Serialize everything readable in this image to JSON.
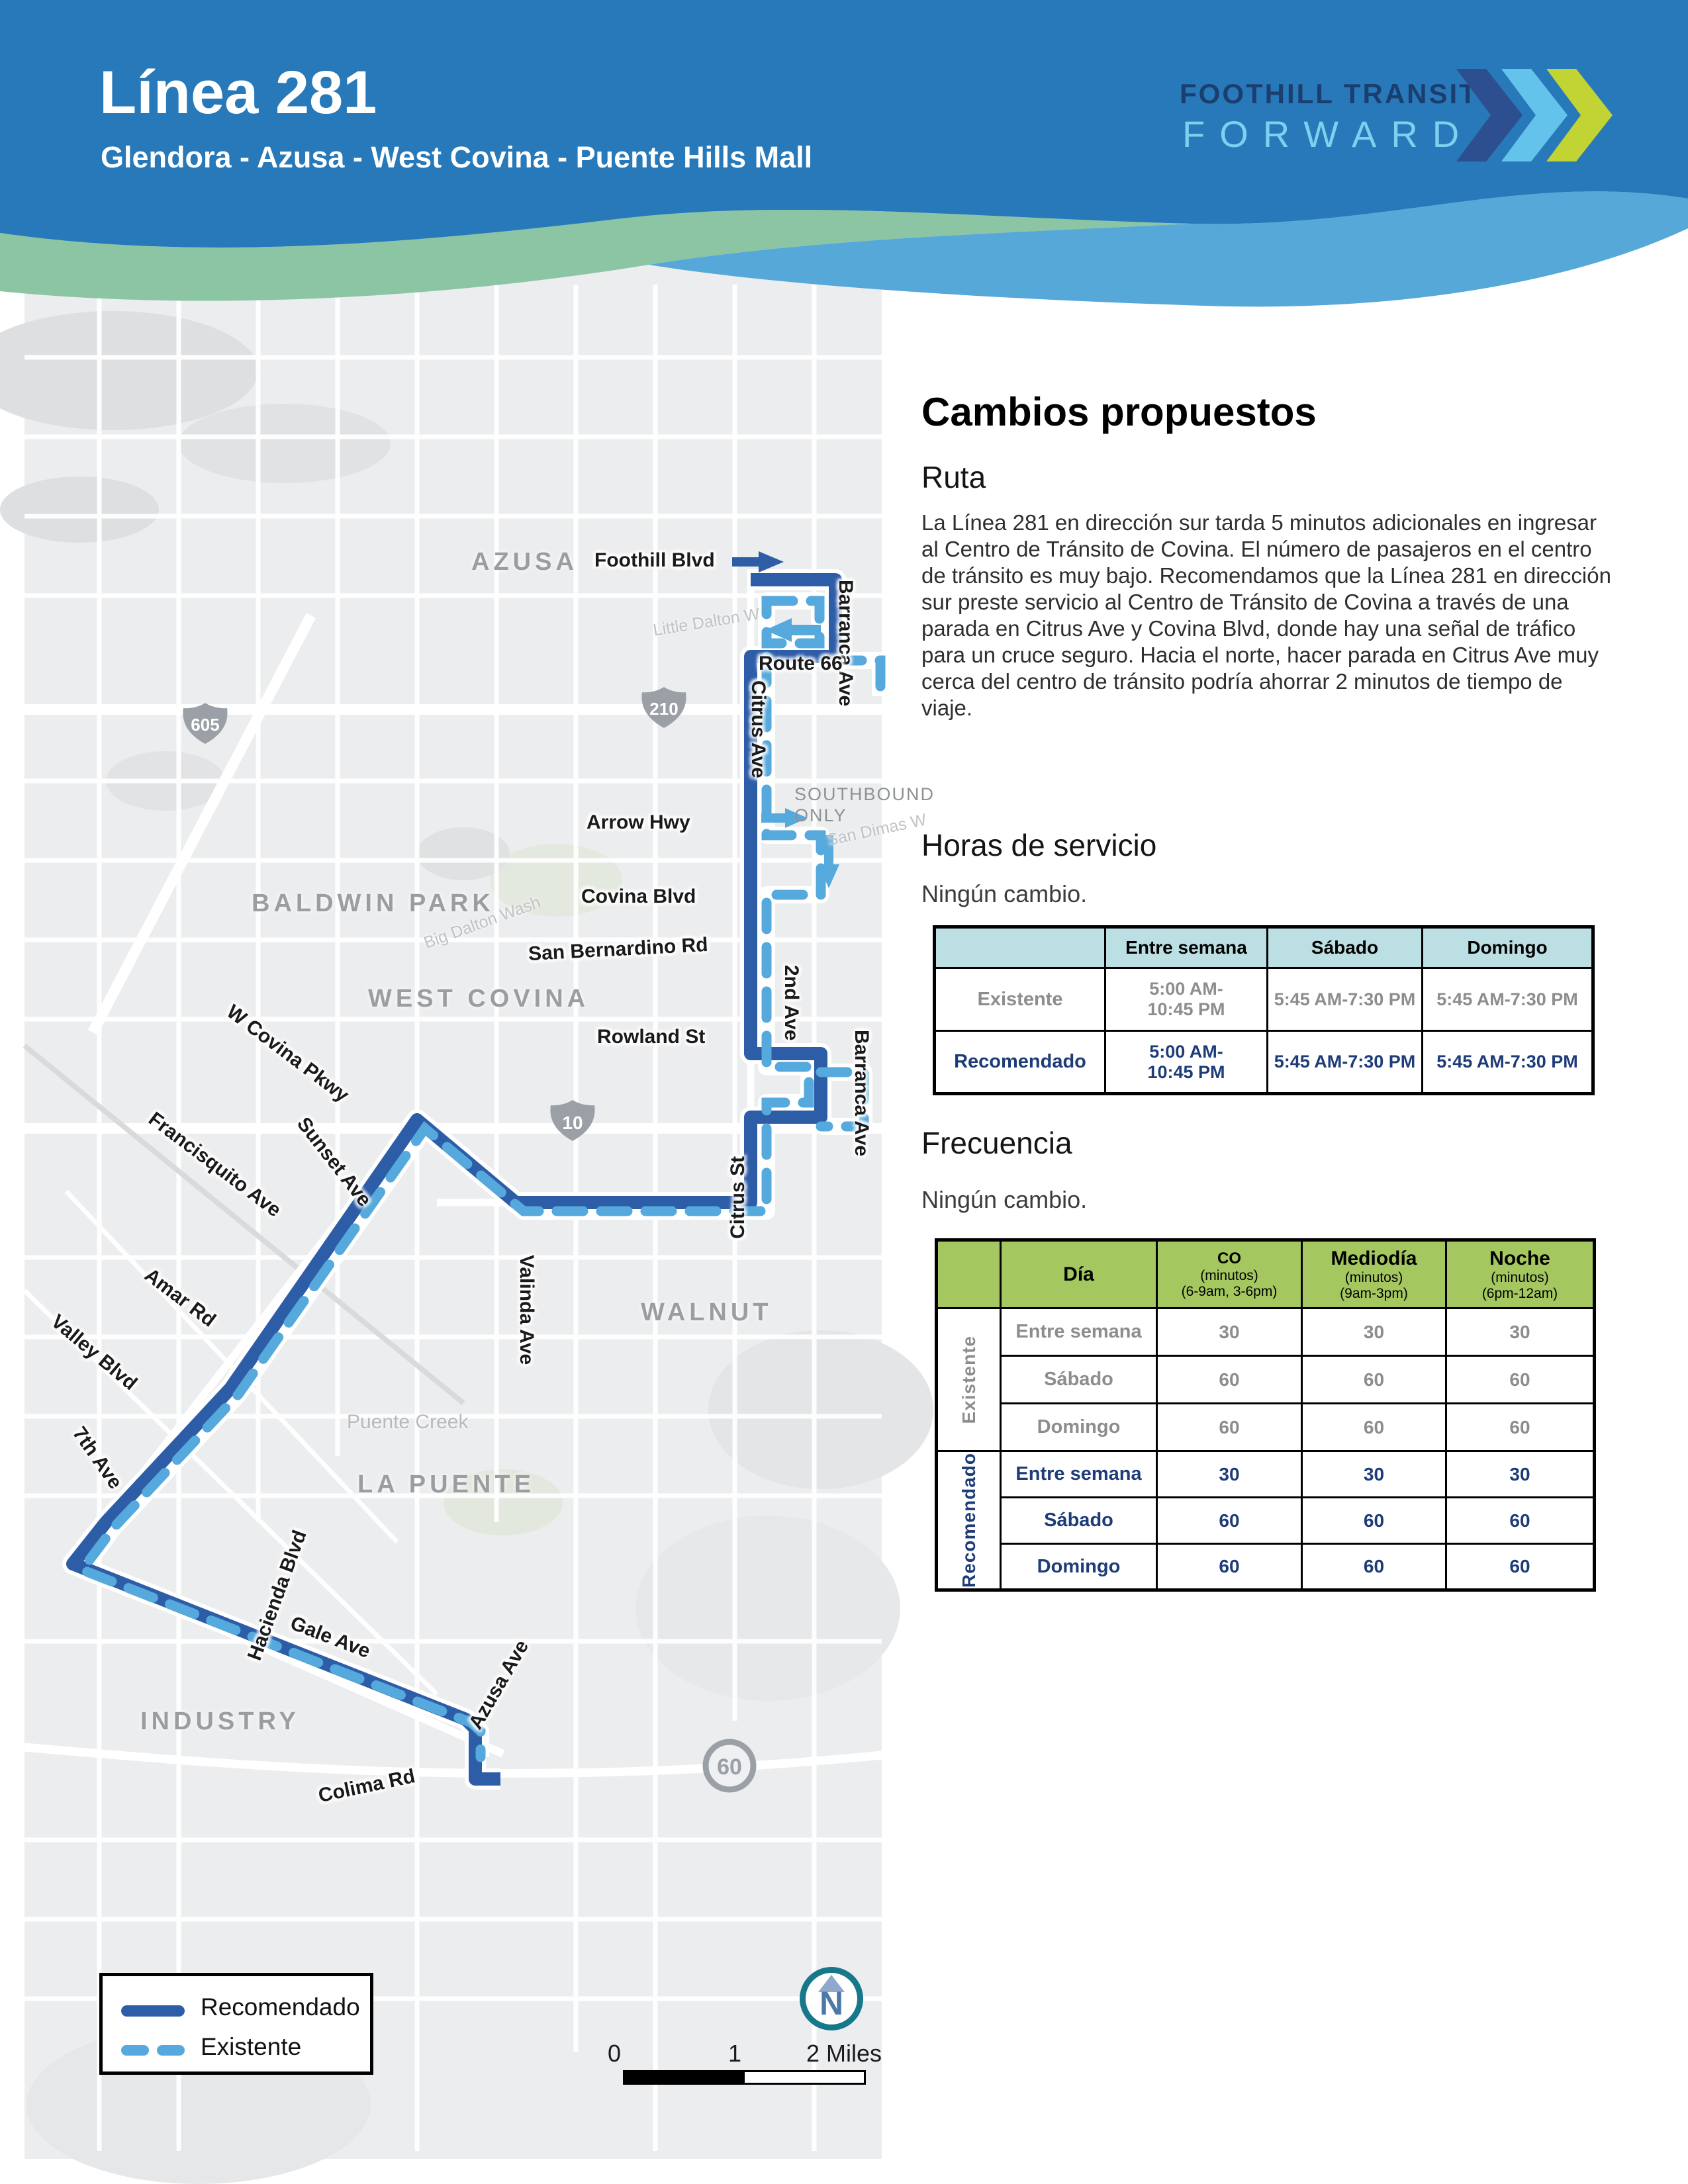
{
  "header": {
    "route_title": "Línea 281",
    "route_subtitle": "Glendora - Azusa - West Covina - Puente Hills Mall",
    "brand_line1": "FOOTHILL TRANSIT",
    "brand_line2": "FORWARD",
    "colors": {
      "band": "#2779B9",
      "wave_green": "#8CC5A3",
      "wave_blue": "#55A8D8",
      "brand_navy": "#1B3E6F",
      "brand_lightblue": "#7ED0EE",
      "brand_lime": "#C2D433"
    }
  },
  "map": {
    "cities": {
      "azusa": "AZUSA",
      "baldwin_park": "BALDWIN PARK",
      "west_covina": "WEST COVINA",
      "walnut": "WALNUT",
      "la_puente": "LA PUENTE",
      "industry": "INDUSTRY"
    },
    "streets": {
      "foothill": "Foothill Blvd",
      "barranca1": "Barranca Ave",
      "route66": "Route 66",
      "citrus_ave": "Citrus Ave",
      "arrow": "Arrow Hwy",
      "covina_blvd": "Covina Blvd",
      "san_bernardino": "San Bernardino Rd",
      "second_ave": "2nd Ave",
      "barranca2": "Barranca Ave",
      "rowland": "Rowland St",
      "citrus_st": "Citrus St",
      "w_covina_pkwy": "W Covina Pkwy",
      "francisquito": "Francisquito Ave",
      "sunset": "Sunset Ave",
      "amar": "Amar Rd",
      "valley": "Valley Blvd",
      "valinda": "Valinda Ave",
      "seventh": "7th Ave",
      "hacienda": "Hacienda Blvd",
      "gale": "Gale Ave",
      "azusa_ave": "Azusa Ave",
      "colima": "Colima Rd"
    },
    "faint": {
      "little_dalton": "Little Dalton W",
      "san_dimas": "San Dimas W",
      "big_dalton": "Big Dalton Wash",
      "puente_creek": "Puente Creek"
    },
    "southbound_line1": "SOUTHBOUND",
    "southbound_line2": "ONLY",
    "shields": {
      "i605": "605",
      "i210": "210",
      "i10": "10",
      "sr60": "60"
    },
    "legend": {
      "recommended": "Recomendado",
      "existing": "Existente"
    },
    "scale": {
      "zero": "0",
      "one": "1",
      "two": "2 Miles"
    },
    "north_letter": "N",
    "route_colors": {
      "recommended": "#2E5DA8",
      "existing": "#55A9DC"
    }
  },
  "content": {
    "heading": "Cambios propuestos",
    "route_heading": "Ruta",
    "route_paragraph": "La Línea 281 en dirección sur tarda 5 minutos adicionales en ingresar al Centro de Tránsito de Covina. El número de pasajeros en el centro de tránsito es muy bajo. Recomendamos que la Línea 281 en dirección sur preste servicio al Centro de Tránsito de Covina a través de una parada en Citrus Ave y Covina Blvd, donde hay una señal de tráfico para un cruce seguro. Hacia el norte, hacer parada en Citrus Ave muy cerca del centro de tránsito podría ahorrar 2 minutos de tiempo de viaje.",
    "hours_heading": "Horas de servicio",
    "hours_note": "Ningún cambio.",
    "hours_table": {
      "col_weekday": "Entre semana",
      "col_saturday": "Sábado",
      "col_sunday": "Domingo",
      "rows": [
        {
          "label": "Existente",
          "weekday": "5:00 AM-10:45 PM",
          "saturday": "5:45 AM-7:30 PM",
          "sunday": "5:45 AM-7:30 PM"
        },
        {
          "label": "Recomendado",
          "weekday": "5:00 AM-10:45 PM",
          "saturday": "5:45 AM-7:30 PM",
          "sunday": "5:45 AM-7:30 PM"
        }
      ]
    },
    "frequency_heading": "Frecuencia",
    "frequency_note": "Ningún cambio.",
    "frequency_table": {
      "col_day": "Día",
      "col_peak_title": "CO",
      "col_peak_sub1": "(minutos)",
      "col_peak_sub2": "(6-9am, 3-6pm)",
      "col_midday_title": "Mediodía",
      "col_midday_sub1": "(minutos)",
      "col_midday_sub2": "(9am-3pm)",
      "col_night_title": "Noche",
      "col_night_sub1": "(minutos)",
      "col_night_sub2": "(6pm-12am)",
      "group_existing": "Existente",
      "group_recommended": "Recomendado",
      "rows": [
        {
          "day": "Entre semana",
          "peak": "30",
          "midday": "30",
          "night": "30"
        },
        {
          "day": "Sábado",
          "peak": "60",
          "midday": "60",
          "night": "60"
        },
        {
          "day": "Domingo",
          "peak": "60",
          "midday": "60",
          "night": "60"
        },
        {
          "day": "Entre semana",
          "peak": "30",
          "midday": "30",
          "night": "30"
        },
        {
          "day": "Sábado",
          "peak": "60",
          "midday": "60",
          "night": "60"
        },
        {
          "day": "Domingo",
          "peak": "60",
          "midday": "60",
          "night": "60"
        }
      ]
    }
  }
}
